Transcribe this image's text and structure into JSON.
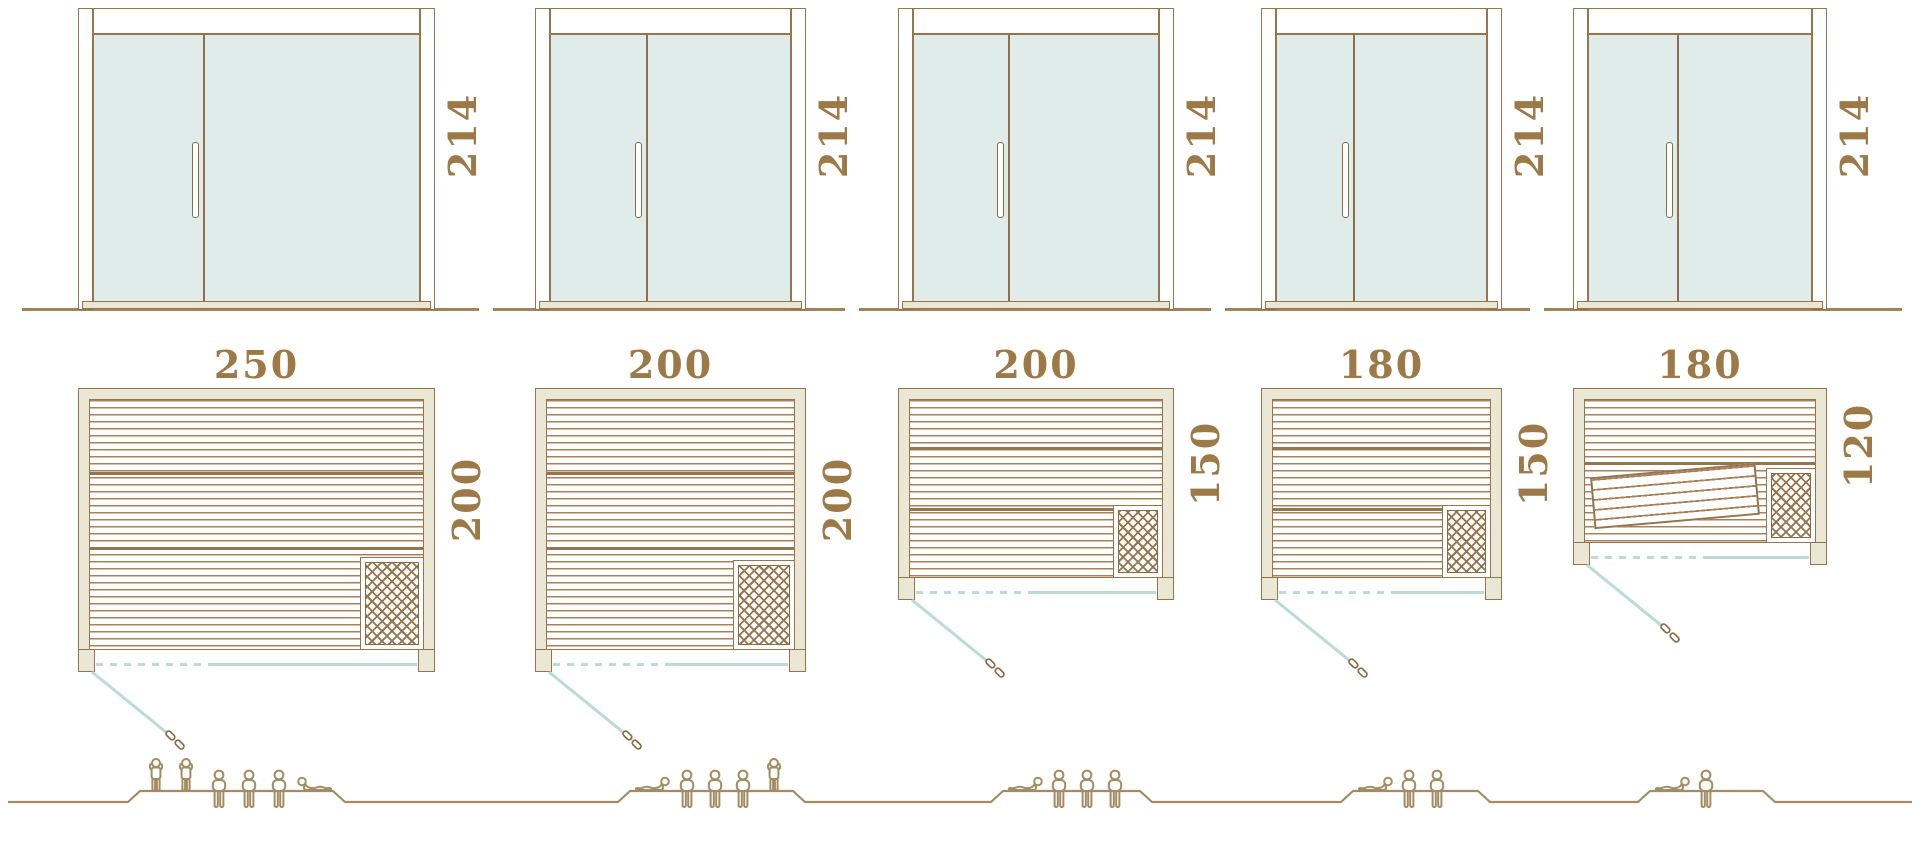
{
  "diagram": {
    "kind": "sauna size comparison drawing",
    "rows": [
      "door elevations",
      "floor plans",
      "capacity figures"
    ]
  },
  "units": [
    {
      "name": "sauna-250x200",
      "door_height_label": "214",
      "plan_width_label": "250",
      "plan_depth_label": "200",
      "arrangement": [
        "standing",
        "standing",
        "seated",
        "seated",
        "seated",
        "lying"
      ],
      "capacity": {
        "standing": 2,
        "seated": 3,
        "lying": 1,
        "total": 6
      }
    },
    {
      "name": "sauna-200x200",
      "door_height_label": "214",
      "plan_width_label": "200",
      "plan_depth_label": "200",
      "arrangement": [
        "lying",
        "seated",
        "seated",
        "seated",
        "standing"
      ],
      "capacity": {
        "standing": 1,
        "seated": 3,
        "lying": 1,
        "total": 5
      }
    },
    {
      "name": "sauna-200x150",
      "door_height_label": "214",
      "plan_width_label": "200",
      "plan_depth_label": "150",
      "arrangement": [
        "lying",
        "seated",
        "seated",
        "seated"
      ],
      "capacity": {
        "standing": 0,
        "seated": 3,
        "lying": 1,
        "total": 4
      }
    },
    {
      "name": "sauna-180x150",
      "door_height_label": "214",
      "plan_width_label": "180",
      "plan_depth_label": "150",
      "arrangement": [
        "lying",
        "seated",
        "seated"
      ],
      "capacity": {
        "standing": 0,
        "seated": 2,
        "lying": 1,
        "total": 3
      }
    },
    {
      "name": "sauna-180x120",
      "door_height_label": "214",
      "plan_width_label": "180",
      "plan_depth_label": "120",
      "arrangement": [
        "lying",
        "seated"
      ],
      "capacity": {
        "standing": 0,
        "seated": 1,
        "lying": 1,
        "total": 2
      }
    }
  ],
  "colors": {
    "outline_brown": "#96744e",
    "slat_brown": "#a8805a",
    "label_brown": "#9c7946",
    "wall_fill": "#eae7d5",
    "glass_fill": "#dfecea",
    "door_swing_teal": "#bcdad6",
    "people_brown": "#a28c63",
    "background": "#ffffff"
  }
}
